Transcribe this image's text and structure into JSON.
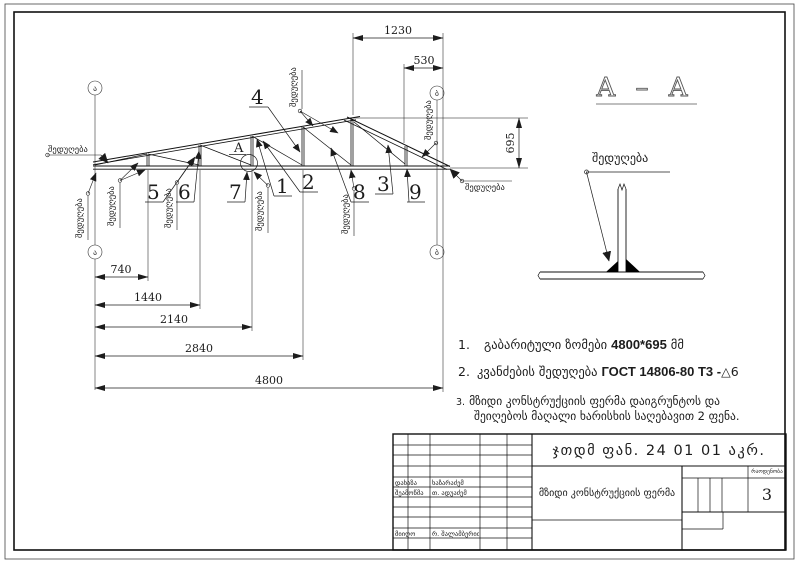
{
  "sheet": {
    "axis_left": "ა",
    "axis_right": "ბ",
    "weld": "შედუღება",
    "detail_label": "A",
    "section_title": "A – A",
    "parts": [
      "1",
      "2",
      "3",
      "4",
      "5",
      "6",
      "7",
      "8",
      "9"
    ],
    "dims": {
      "top": "1230",
      "top2": "530",
      "h": "695",
      "b1": "740",
      "b2": "1440",
      "b3": "2140",
      "b4": "2840",
      "b5": "4800"
    }
  },
  "notes": {
    "n1_num": "1.",
    "n1_text": "გაბარიტული ზომები",
    "n1_bold": "4800*695",
    "n1_unit": "მმ",
    "n2_num": "2.",
    "n2_text": "კვანძების შედუღება",
    "n2_bold": "ГОСТ 14806-80 Т3 -",
    "n2_symbol": "△6",
    "n3_num": "3.",
    "n3_line1": "მზიდი კონსტრუქციის ფერმა დაიგრუნტოს და",
    "n3_line2": "შეიღებოს მაღალი ხარისხის საღებავით 2 ფენა."
  },
  "title_block": {
    "doc_number": "ჯთდმ ფან. 24 01 01 აკრ.",
    "title": "მზიდი კონსტრუქციის ფერმა",
    "qty_label": "რაოდენობა",
    "qty_value": "3",
    "row1_label": "დახაზა",
    "row1_name": "ხაზარაძემ",
    "row2_label": "შეამოწმა",
    "row2_name": "თ. ადუაძემ",
    "row3_label": "მიიღო",
    "row3_name": "რ. შალამბერიძემ"
  }
}
